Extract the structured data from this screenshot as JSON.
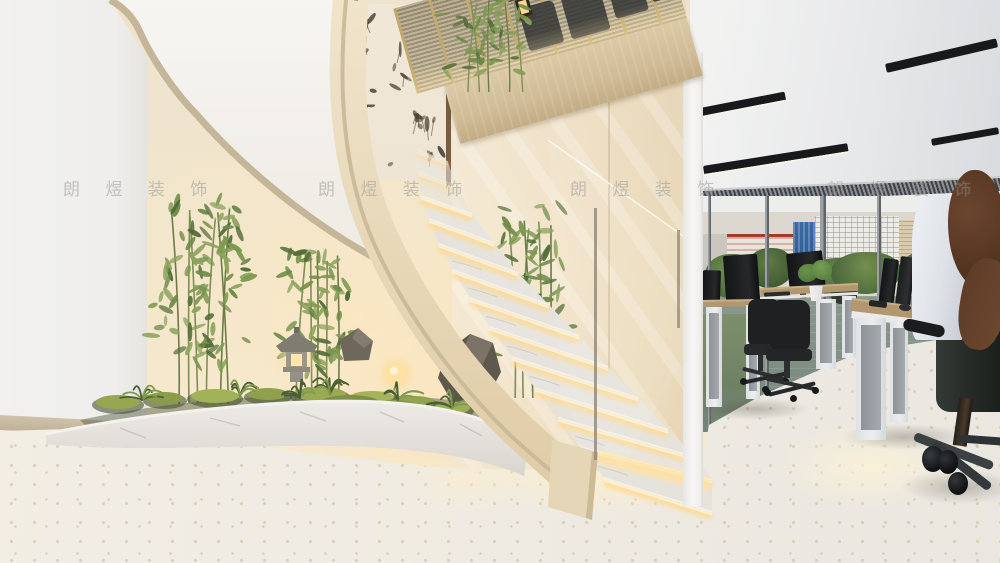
{
  "meta": {
    "type": "3d-interior-render",
    "scene_description": "Modern office interior: curved marble staircase with LED-lit treads wrapping an indoor zen garden (bamboo, stone lantern, moss, rocks), glass balustrade, glossy cream feature wall, mezzanine with bronze mesh screen and hanging lantern, open-plan office with black linear ceiling lights, city-view glazing, timber desks, black task chairs and a seated person with long auburn hair"
  },
  "watermark": {
    "text": "朗 煜 装 饰",
    "color": "#7d7b76",
    "instances": 4
  },
  "palette": {
    "warm_wall": "#f2e7d0",
    "white_wall": "#f1f0ee",
    "stringer_cream": "#e8d9ba",
    "marble_tread": "#e7e4df",
    "led_glow": "#ffdf9e",
    "mesh_bronze": "#b5a98c",
    "fascia_wood": "#d3c09b",
    "office_ceiling": "#e9eaeb",
    "light_fixture_black": "#17191b",
    "city_glass_blue": "#2f5e97",
    "foliage_green": "#6e8a48",
    "moss_green": "#9aaa52",
    "water_gray_green": "#87968c",
    "desk_wood": "#b2976f",
    "chair_black": "#1e2022",
    "terrazzo_floor": "#f0ece3",
    "hair_auburn": "#5d3b2a",
    "shirt_white": "#e7eaee"
  }
}
